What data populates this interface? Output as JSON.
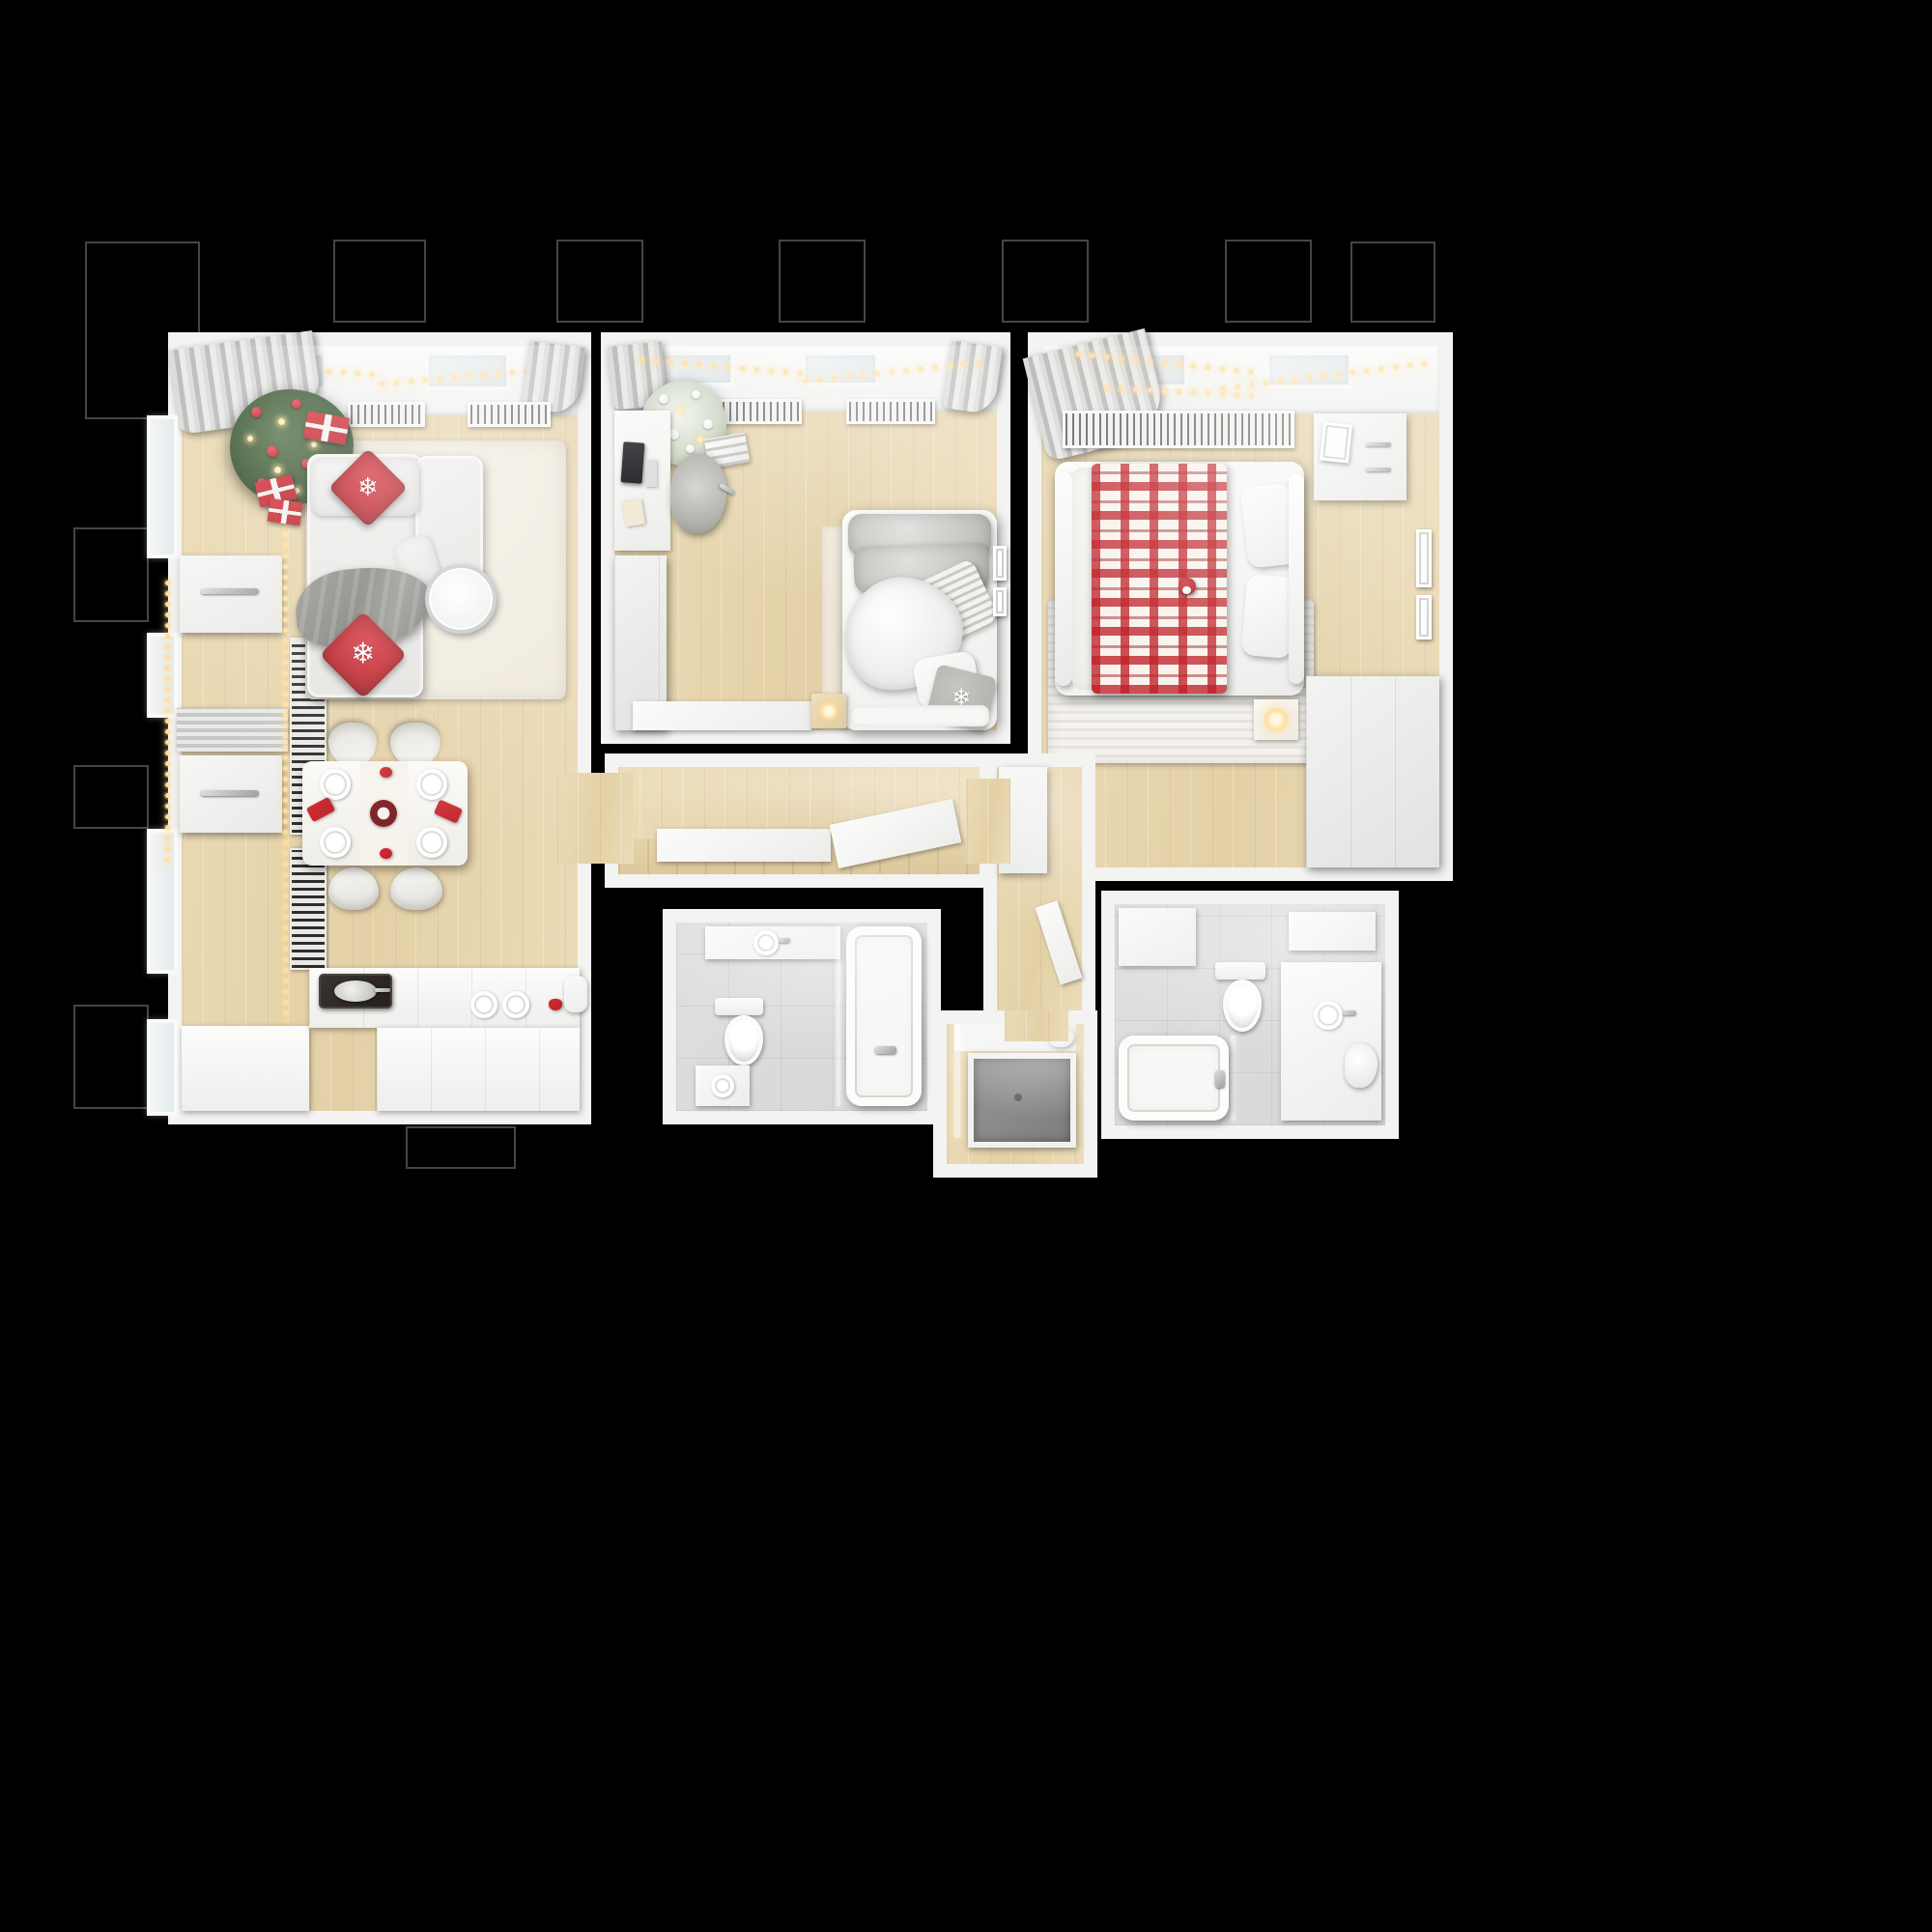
{
  "scene": {
    "title": "Top-down 3D floor plan of an apartment decorated for Christmas",
    "style": "photoreal render, white/gray interior with red holiday accents on black background"
  },
  "palette": {
    "bg": "#000000",
    "wall": "#f3f3f1",
    "wood": "#ecdcb8",
    "wood2": "#e3d0a6",
    "tile": "#d6d6d4",
    "sofa": "#e2e1de",
    "rug": "#efe9dc",
    "red": "#bf2129",
    "glow": "#ffdfa0"
  },
  "icons": {
    "snowflake": "❄"
  },
  "rooms": [
    {
      "id": "living",
      "label": "Living room & kitchen",
      "furniture": [
        "Christmas tree with red baubles",
        "Red gift boxes",
        "Corner sofa",
        "Snowflake pillow",
        "Wool throw",
        "Chrome side table",
        "Area rug",
        "Dining table set for four",
        "Dining chair",
        "Festive centerpiece wreath",
        "Kitchen counter",
        "Induction cooktop with pan",
        "Radiator grille",
        "Gray curtains",
        "String lights",
        "Wall light bar",
        "Roller blinds",
        "Vertical radiator",
        "Window"
      ]
    },
    {
      "id": "kids",
      "label": "Kids room / study",
      "furniture": [
        "Desk",
        "Monitor",
        "Desk chair",
        "Flocked Christmas tree",
        "White gift stack",
        "Wardrobe",
        "Single bed",
        "Plush throw",
        "Striped pillow",
        "Snowflake pillow",
        "Bedside glow lamp",
        "Radiator grille",
        "Wall frames",
        "Low cabinet",
        "Bed platform"
      ]
    },
    {
      "id": "master",
      "label": "Master bedroom",
      "furniture": [
        "Double bed",
        "Red check plaid blanket",
        "Pillows",
        "Santa gnome",
        "Nightstand with glow lamp",
        "Dresser with frame",
        "Wall frames",
        "Wardrobe",
        "Striped rug",
        "Radiator grille",
        "Gray curtain",
        "String lights"
      ]
    },
    {
      "id": "hallway",
      "label": "Hallway",
      "furniture": [
        "Console shelf",
        "Leaning panel"
      ]
    },
    {
      "id": "bath1",
      "label": "Bathroom",
      "furniture": [
        "Vanity shelf with basin",
        "Toilet",
        "Bathtub",
        "Chrome mixer",
        "Washer",
        "Glass screen"
      ]
    },
    {
      "id": "shower",
      "label": "Shower room",
      "furniture": [
        "Shower tray",
        "Glass screen",
        "Towel"
      ]
    },
    {
      "id": "bath2",
      "label": "Second bathroom",
      "furniture": [
        "Storage cabinet",
        "Toilet",
        "Bathtub",
        "Chrome mixer",
        "Vanity cabinet",
        "Towel",
        "Glass screen"
      ]
    },
    {
      "id": "corridor",
      "label": "Inner corridor",
      "furniture": [
        "Tall cabinet",
        "Open door leaf"
      ]
    }
  ],
  "exterior": {
    "label": "Exterior wall ledge outline"
  }
}
